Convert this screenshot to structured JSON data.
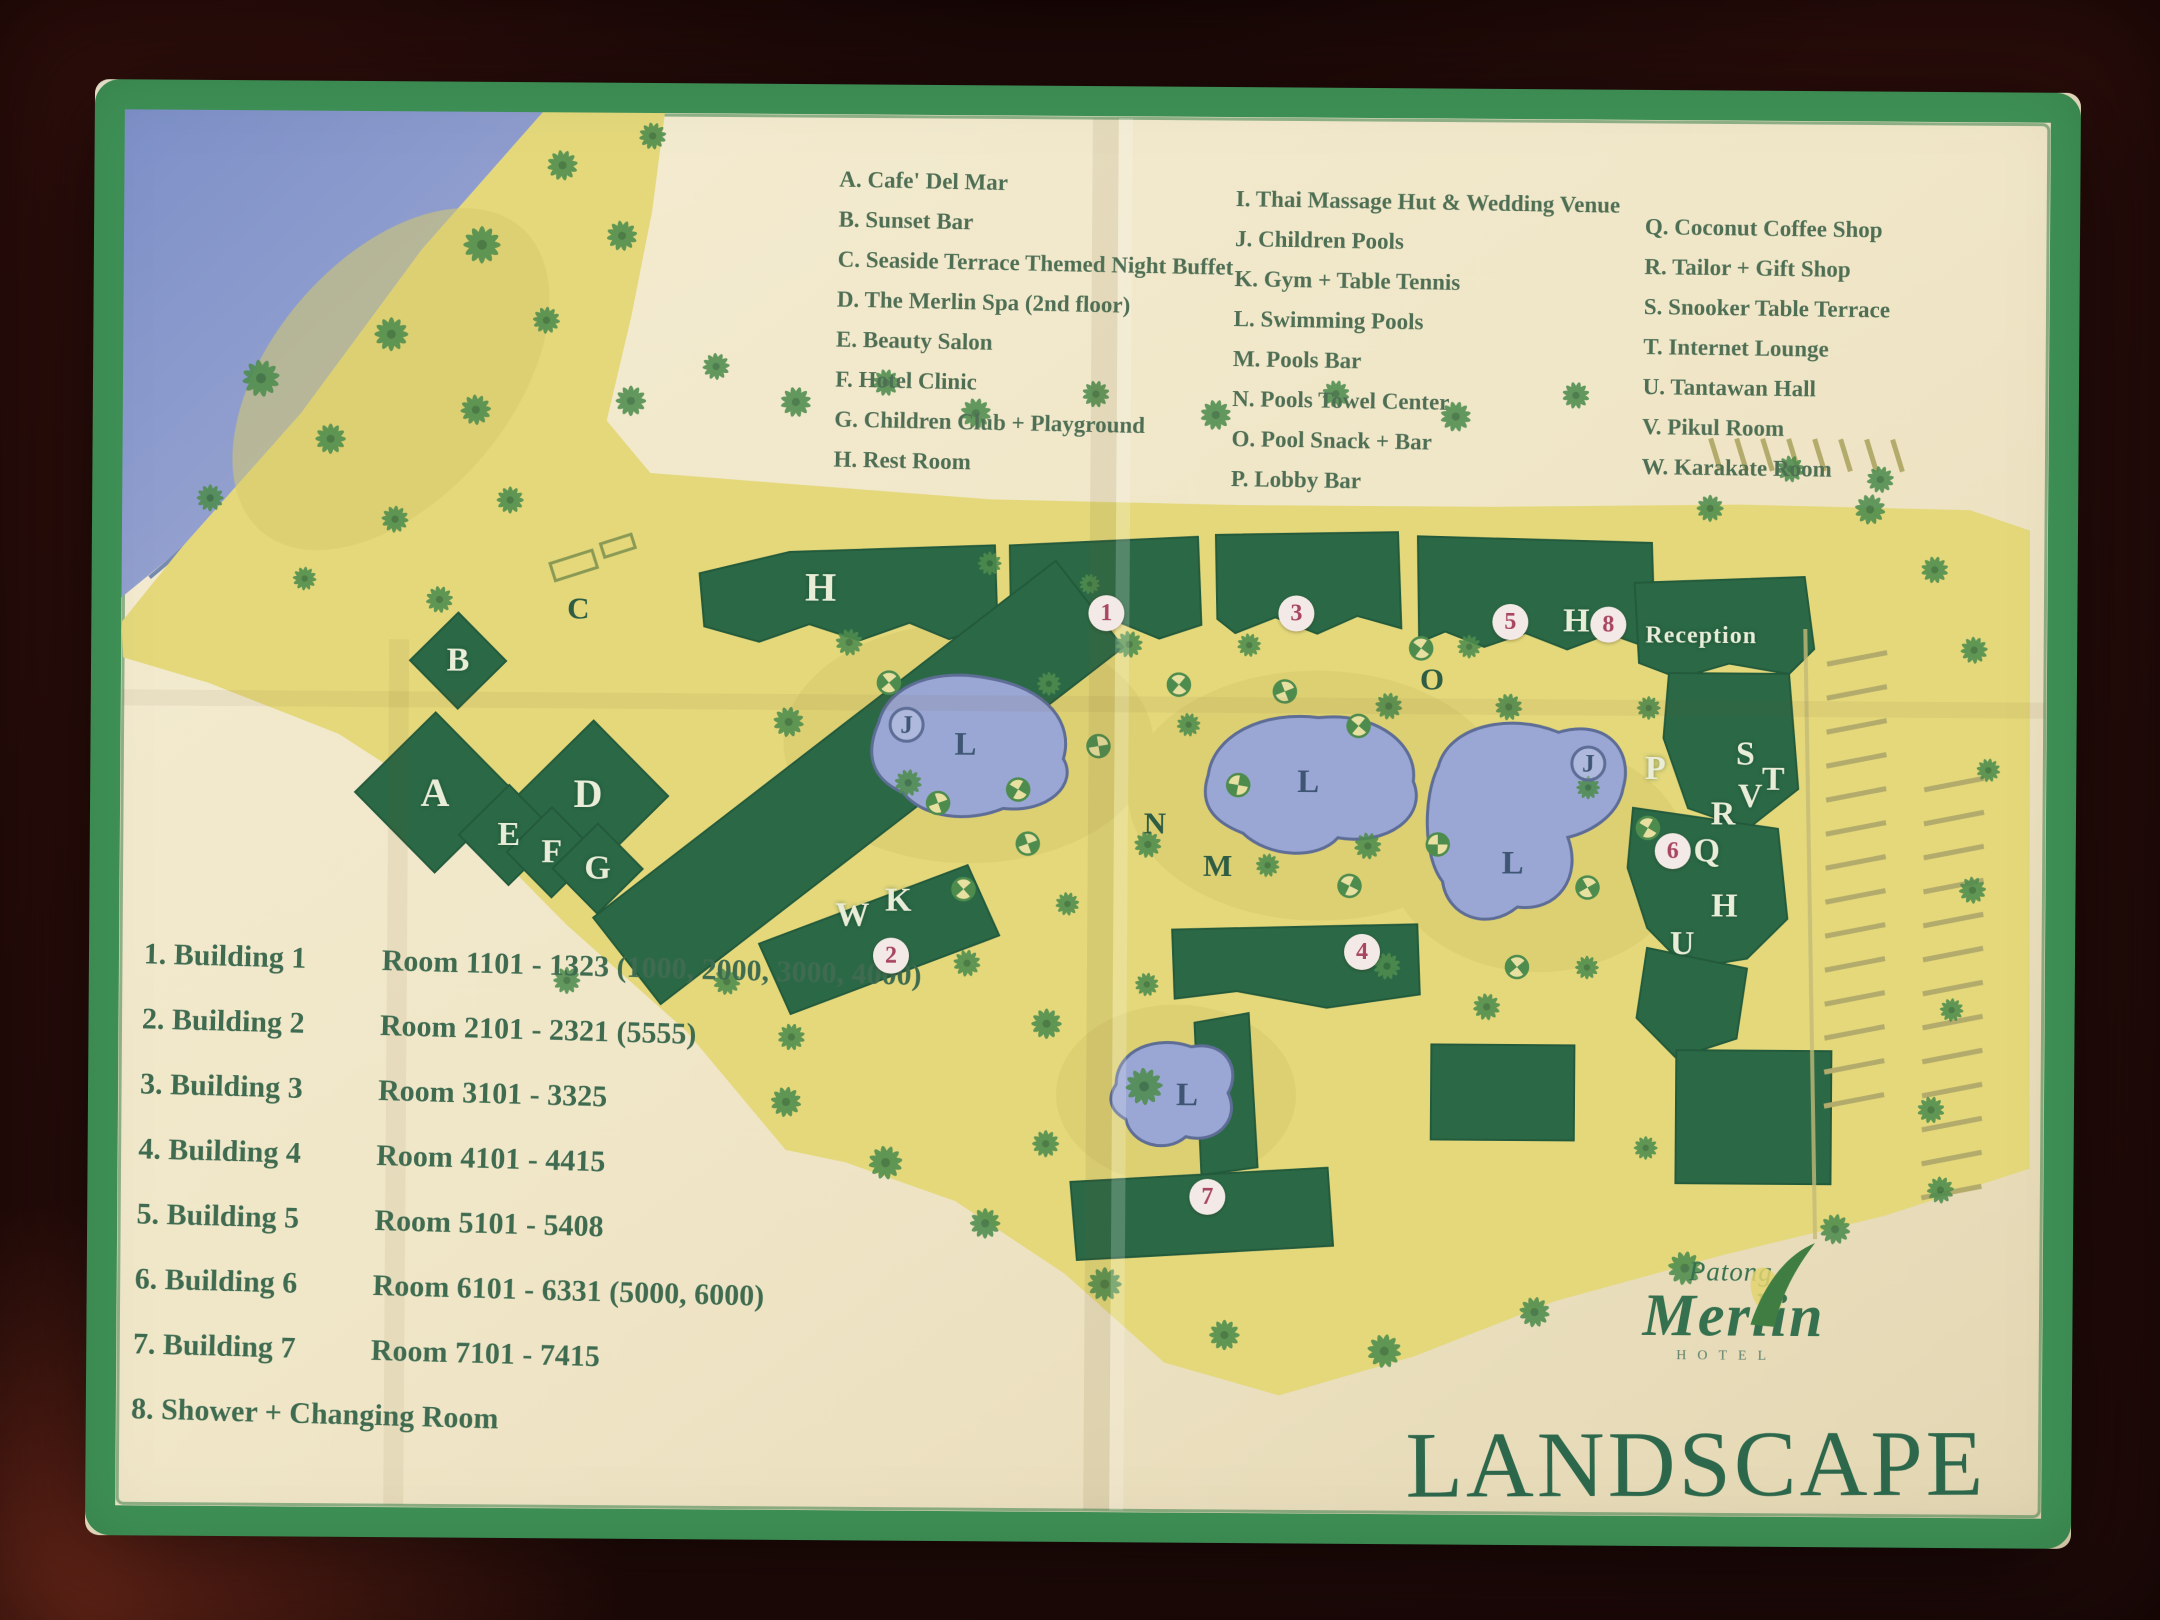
{
  "colors": {
    "table_wood": "#2b0e0b",
    "paper": "#efe5c6",
    "border_green": "#3e9156",
    "land_yellow": "#e4d87b",
    "building_green": "#2b6946",
    "pool_blue": "#9aa7d4",
    "sea_blue": "#8495cc",
    "legend_text": "#4f6f55",
    "title_green": "#2d684c",
    "number_red": "#a84560"
  },
  "legend": {
    "col1": [
      "A. Cafe' Del Mar",
      "B. Sunset Bar",
      "C. Seaside Terrace Themed Night Buffet",
      "D. The Merlin Spa (2nd floor)",
      "E. Beauty Salon",
      "F. Hotel Clinic",
      "G. Children Club + Playground",
      "H. Rest Room"
    ],
    "col2": [
      "I. Thai Massage Hut & Wedding Venue",
      "J. Children Pools",
      "K. Gym + Table Tennis",
      "L. Swimming Pools",
      "M. Pools Bar",
      "N. Pools Towel Center",
      "O. Pool Snack + Bar",
      "P. Lobby Bar"
    ],
    "col3": [
      "Q. Coconut Coffee Shop",
      "R. Tailor + Gift Shop",
      "S. Snooker Table Terrace",
      "T. Internet Lounge",
      "U. Tantawan Hall",
      "V. Pikul Room",
      "W. Karakate Room"
    ]
  },
  "buildings": [
    {
      "label": "1. Building 1",
      "rooms": "Room 1101 - 1323 (1000, 2000, 3000, 4000)"
    },
    {
      "label": "2. Building 2",
      "rooms": "Room 2101 - 2321 (5555)"
    },
    {
      "label": "3. Building 3",
      "rooms": "Room 3101 - 3325"
    },
    {
      "label": "4. Building 4",
      "rooms": "Room 4101 - 4415"
    },
    {
      "label": "5. Building 5",
      "rooms": "Room 5101 - 5408"
    },
    {
      "label": "6. Building 6",
      "rooms": "Room 6101 - 6331 (5000, 6000)"
    },
    {
      "label": "7. Building 7",
      "rooms": "Room 7101 - 7415"
    },
    {
      "label": "8. Shower + Changing Room",
      "rooms": ""
    }
  ],
  "map": {
    "reception": {
      "text": "Reception",
      "x": 1612,
      "y": 548
    },
    "labels": [
      {
        "text": "B",
        "x": 369,
        "y": 581,
        "kind": "light"
      },
      {
        "text": "A",
        "x": 347,
        "y": 713,
        "kind": "lightbig"
      },
      {
        "text": "C",
        "x": 489,
        "y": 528,
        "kind": "dark"
      },
      {
        "text": "D",
        "x": 500,
        "y": 713,
        "kind": "lightbig"
      },
      {
        "text": "E",
        "x": 421,
        "y": 755,
        "kind": "light"
      },
      {
        "text": "F",
        "x": 464,
        "y": 772,
        "kind": "light"
      },
      {
        "text": "G",
        "x": 510,
        "y": 788,
        "kind": "light"
      },
      {
        "text": "H",
        "x": 731,
        "y": 505,
        "kind": "lightbig"
      },
      {
        "text": "W",
        "x": 765,
        "y": 833,
        "kind": "light"
      },
      {
        "text": "K",
        "x": 811,
        "y": 818,
        "kind": "light"
      },
      {
        "text": "H",
        "x": 1487,
        "y": 534,
        "kind": "light"
      },
      {
        "text": "O",
        "x": 1343,
        "y": 593,
        "kind": "dark"
      },
      {
        "text": "N",
        "x": 1067,
        "y": 739,
        "kind": "dark"
      },
      {
        "text": "M",
        "x": 1130,
        "y": 781,
        "kind": "dark"
      },
      {
        "text": "P",
        "x": 1567,
        "y": 681,
        "kind": "light"
      },
      {
        "text": "S",
        "x": 1657,
        "y": 666,
        "kind": "light"
      },
      {
        "text": "T",
        "x": 1685,
        "y": 691,
        "kind": "light"
      },
      {
        "text": "V",
        "x": 1662,
        "y": 708,
        "kind": "light"
      },
      {
        "text": "R",
        "x": 1635,
        "y": 726,
        "kind": "light"
      },
      {
        "text": "Q",
        "x": 1619,
        "y": 763,
        "kind": "light"
      },
      {
        "text": "H",
        "x": 1637,
        "y": 818,
        "kind": "light"
      },
      {
        "text": "U",
        "x": 1595,
        "y": 856,
        "kind": "light"
      },
      {
        "text": "L",
        "x": 877,
        "y": 662,
        "kind": "pool"
      },
      {
        "text": "L",
        "x": 1220,
        "y": 697,
        "kind": "pool"
      },
      {
        "text": "L",
        "x": 1425,
        "y": 777,
        "kind": "pool"
      },
      {
        "text": "L",
        "x": 1101,
        "y": 1011,
        "kind": "pool"
      },
      {
        "text": "J",
        "x": 818,
        "y": 642,
        "kind": "circletter"
      },
      {
        "text": "J",
        "x": 1500,
        "y": 676,
        "kind": "circletter"
      }
    ],
    "numbers": [
      {
        "text": "1",
        "x": 1017,
        "y": 529
      },
      {
        "text": "3",
        "x": 1207,
        "y": 528
      },
      {
        "text": "5",
        "x": 1421,
        "y": 535
      },
      {
        "text": "8",
        "x": 1519,
        "y": 537
      },
      {
        "text": "2",
        "x": 804,
        "y": 873
      },
      {
        "text": "4",
        "x": 1275,
        "y": 866
      },
      {
        "text": "6",
        "x": 1585,
        "y": 763
      },
      {
        "text": "7",
        "x": 1122,
        "y": 1112
      }
    ]
  },
  "logo": {
    "line1": "Patong",
    "line2": "Merlin",
    "line3": "HOTEL"
  },
  "title": "LANDSCAPE"
}
